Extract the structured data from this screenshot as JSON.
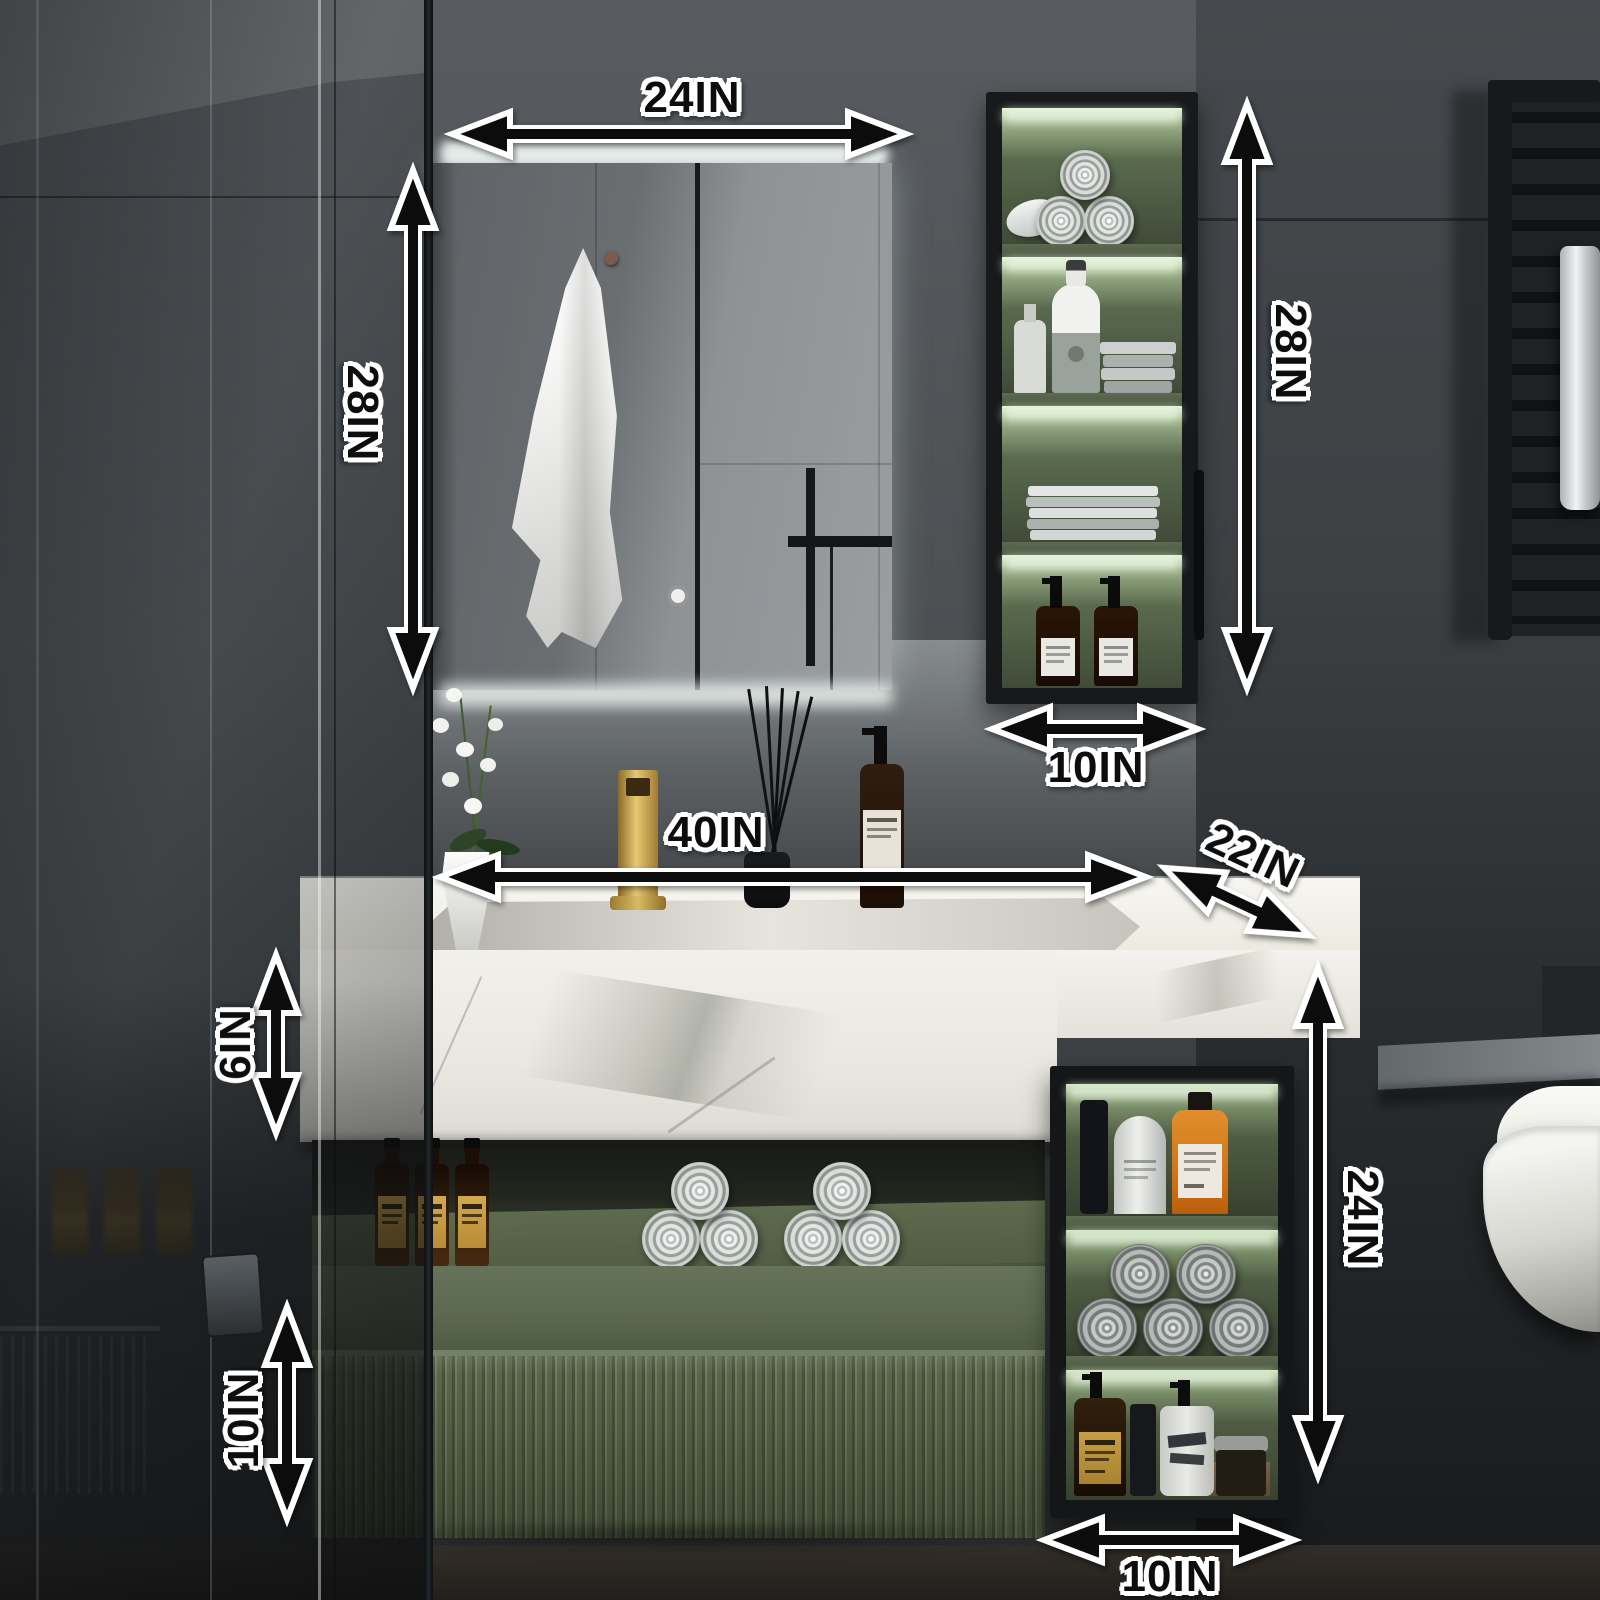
{
  "product": {
    "kind": "bathroom-vanity-dimension-diagram",
    "colors": {
      "cabinet_green": "#6d7a5f",
      "marble_white": "#f0eee8",
      "frame_black": "#17191b",
      "faucet_gold": "#d4ab52",
      "led_glow_green": "#e6f3dc",
      "annotation_ink": "#0d0d0d",
      "annotation_outline": "#ffffff",
      "wall_grey": "#4c5054"
    }
  },
  "dimensions": {
    "mirror_width": "24IN",
    "mirror_height": "28IN",
    "wall_cabinet_height": "28IN",
    "wall_cabinet_width": "10IN",
    "vanity_width": "40IN",
    "vanity_depth": "22IN",
    "countertop_height": "6IN",
    "side_cabinet_height": "24IN",
    "drawer_height": "10IN",
    "side_cabinet_width": "10IN"
  },
  "scene_items": [
    "led-mirror",
    "hanging-towel",
    "wall-hung-cabinet",
    "rolled-towels",
    "toiletry-bottles",
    "marble-countertop",
    "integrated-sink",
    "gold-faucet",
    "orchid",
    "reed-diffuser",
    "soap-dispenser",
    "open-shelf",
    "fluted-drawer",
    "side-shelf-unit",
    "towel-radiator",
    "wall-hung-toilet",
    "glass-shower-panel"
  ]
}
